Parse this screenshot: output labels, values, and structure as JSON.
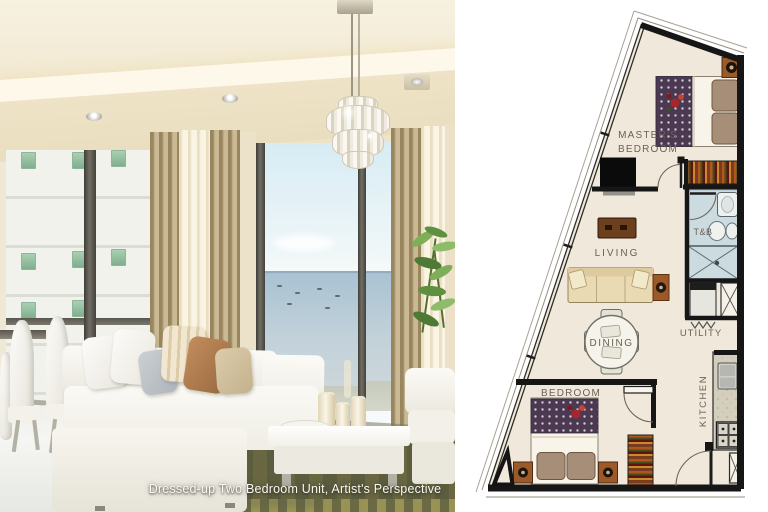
{
  "caption": "Dressed-up Two Bedroom Unit, Artist's Perspective",
  "floor_plan": {
    "labels": {
      "masters_line1": "MASTER'S",
      "masters_line2": "BEDROOM",
      "tb": "T&B",
      "living": "LIVING",
      "dining": "DINING",
      "utility": "UTILITY",
      "bedroom": "BEDROOM",
      "kitchen": "KITCHEN"
    },
    "colors": {
      "wall": "#161616",
      "floor": "#f0e9db",
      "bathroom_floor": "#cbdbdf",
      "kitchen_counter": "#d4cebd",
      "wood_accent": "#9c5a28",
      "bedding_pattern": "#4a3950",
      "label_text": "#6b6156"
    }
  },
  "photo": {
    "colors": {
      "ceiling": "#f4ecd9",
      "curtain_tan": "#b5a176",
      "sheer": "#f4ecd8",
      "sky": "#d7ecf4",
      "sea": "#b0c6d4",
      "rug_olive": "#5c5c3e",
      "sofa_white": "#f7f5ef"
    }
  }
}
